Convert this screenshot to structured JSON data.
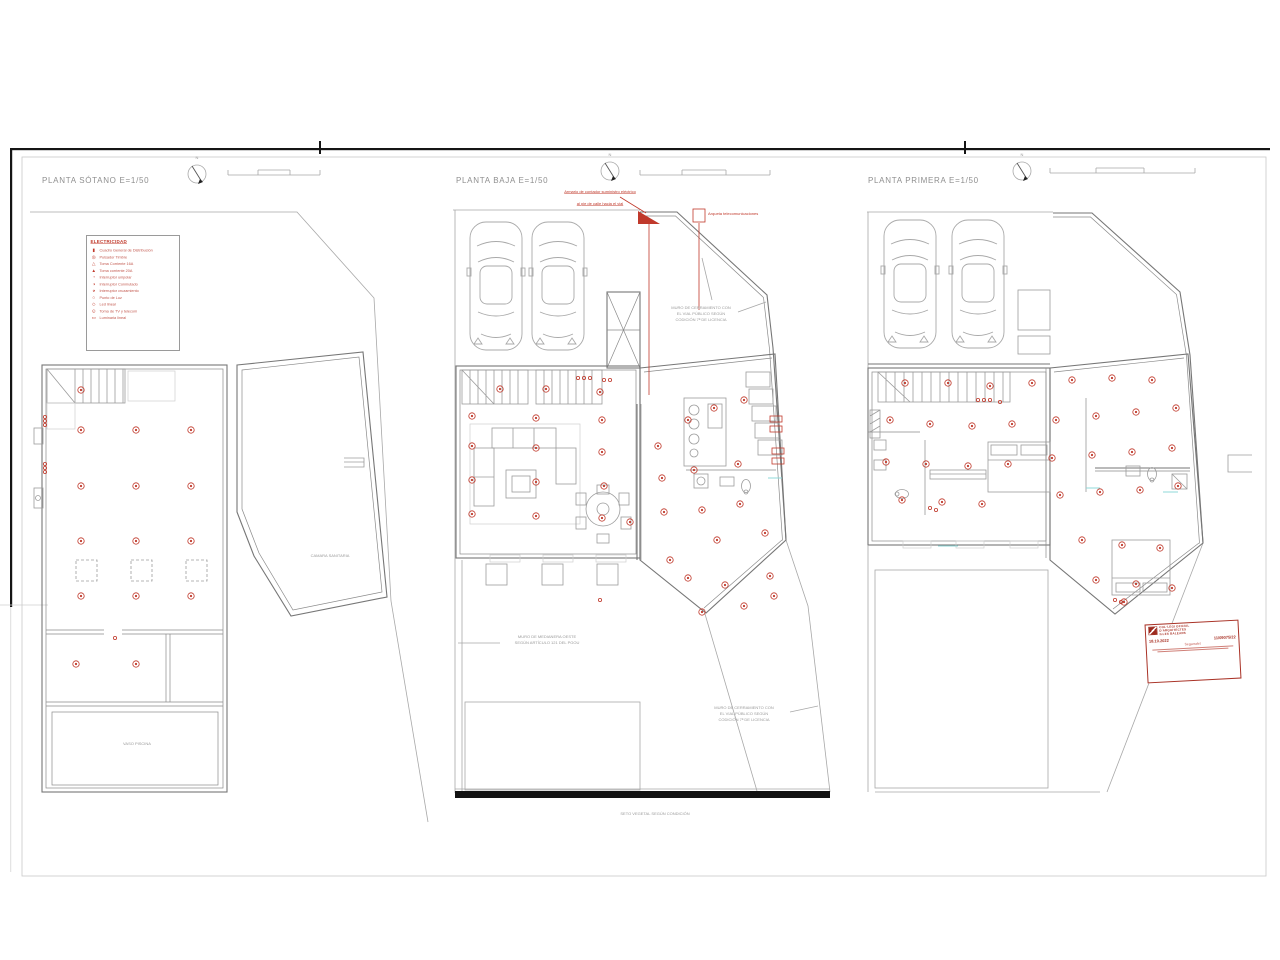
{
  "plans": [
    {
      "id": "sotano",
      "title": "PLANTA SÓTANO E=1/50"
    },
    {
      "id": "baja",
      "title": "PLANTA BAJA E=1/50"
    },
    {
      "id": "primera",
      "title": "PLANTA PRIMERA E=1/50"
    }
  ],
  "north_label": "N",
  "legend": {
    "title": "ELECTRICIDAD",
    "items": [
      {
        "icon": "cuadro-general-distribucion-icon",
        "glyph": "▮",
        "label": "Cuadro General de Distribución"
      },
      {
        "icon": "pulsador-timbre-icon",
        "glyph": "◎",
        "label": "Pulsador Timbre"
      },
      {
        "icon": "toma-corriente-16a-icon",
        "glyph": "△",
        "label": "Toma Corriente 16A"
      },
      {
        "icon": "toma-corriente-20a-icon",
        "glyph": "▲",
        "label": "Toma corriente 20A"
      },
      {
        "icon": "interruptor-unipolar-icon",
        "glyph": "◔",
        "label": "Interruptor unipolar"
      },
      {
        "icon": "interruptor-conmutado-icon",
        "glyph": "◑",
        "label": "Interruptor Conmutado"
      },
      {
        "icon": "interruptor-cruzamiento-icon",
        "glyph": "◕",
        "label": "Interruptor cruzamiento"
      },
      {
        "icon": "punto-de-luz-icon",
        "glyph": "○",
        "label": "Punto de Luz"
      },
      {
        "icon": "led-lineal-icon",
        "glyph": "◇",
        "label": "Led lineal"
      },
      {
        "icon": "toma-tv-telecom-icon",
        "glyph": "⊙",
        "label": "Toma de TV y telecom"
      },
      {
        "icon": "luminaria-lineal-icon",
        "glyph": "▭",
        "label": "Luminaria lineal"
      }
    ]
  },
  "annotations": {
    "armario_1": "Armario de contador suministro eléctrico",
    "armario_2": "al pie de calle hacia el vial",
    "arqueta": "Arqueta telecomunicaciones",
    "muro_cerramiento_norte": "MURO DE CERRAMIENTO CON\nEL VIAL PÚBLICO SEGÚN\nCODICIÓN 7ª DE LICENCIA",
    "muro_medianera": "MURO DE MEDIANERA OESTE\nSEGÚN ARTÍCULO 121 DEL PGOU",
    "muro_cerramiento_sur": "MURO DE CERRAMIENTO CON\nEL VIAL PÚBLICO SEGÚN\nCODICIÓN 7ª DE LICENCIA",
    "seto": "SETO VEGETAL SEGÚN CONDICIÓN",
    "camara_sanitaria": "CAMARA SANITARIA",
    "vaso_piscina": "VASO PISCINA"
  },
  "stamp": {
    "org": "COL·LEGI OFICIAL\nD'ARQUITECTES\nILLES BALEARS",
    "date": "18.10.2022",
    "number": "11/09075/22",
    "name": "Segarralet"
  },
  "colors": {
    "symbol_red": "#c0392b",
    "stamp_red": "#a93226",
    "wall_gray": "#767676",
    "text_gray": "#9a9a9a",
    "hedge_black": "#121212"
  }
}
